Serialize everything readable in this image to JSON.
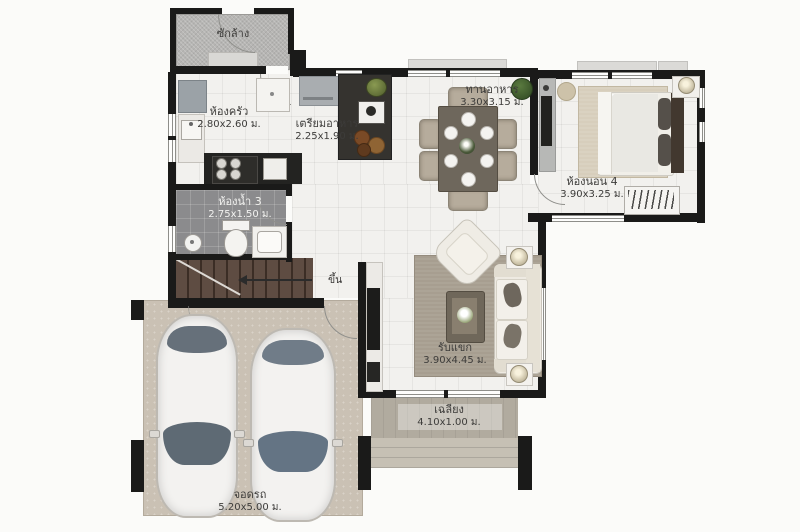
{
  "plan_title": "house-floor-plan",
  "labels": {
    "laundry": {
      "name": "ซักล้าง",
      "dims": ""
    },
    "kitchen": {
      "name": "ห้องครัว",
      "dims": "2.80x2.60 ม."
    },
    "prep": {
      "name": "เตรียมอาหาร",
      "dims": "2.25x1.90 ม."
    },
    "dining": {
      "name": "ทานอาหาร",
      "dims": "3.30x3.15 ม."
    },
    "bedroom4": {
      "name": "ห้องนอน 4",
      "dims": "3.90x3.25 ม."
    },
    "bath3": {
      "name": "ห้องน้ำ 3",
      "dims": "2.75x1.50 ม."
    },
    "living": {
      "name": "รับแขก",
      "dims": "3.90x4.45 ม."
    },
    "terrace": {
      "name": "เฉลียง",
      "dims": "4.10x1.00 ม."
    },
    "garage": {
      "name": "จอดรถ",
      "dims": "5.20x5.00 ม."
    },
    "stairs_up": "ขึ้น"
  },
  "colors": {
    "wall": "#1a1a19",
    "floor_tile": "#f2f1ee",
    "laundry_floor": "#b6b5b3",
    "bath_floor": "#8b8b8d",
    "stairs": "#5e4c42",
    "garage_floor": "#cac1b4",
    "terrace_floor": "#b1ab9f",
    "rug_living": "#a79e90",
    "rug_bedroom": "#d7cebc",
    "plant_green": "#4a6b35",
    "text": "#3d3c3a"
  }
}
